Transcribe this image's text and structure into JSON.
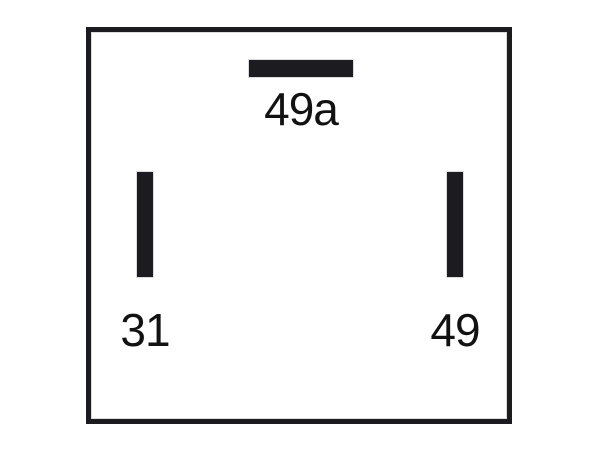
{
  "diagram": {
    "type": "relay-pinout",
    "background": "#ffffff",
    "ink_color": "#1b1b20",
    "label_color": "#121212",
    "terminals": [
      {
        "label": "49a",
        "pin_shape": "horizontal-bar",
        "position": "top-center"
      },
      {
        "label": "31",
        "pin_shape": "vertical-bar",
        "position": "bottom-left"
      },
      {
        "label": "49",
        "pin_shape": "vertical-bar",
        "position": "bottom-right"
      }
    ]
  }
}
